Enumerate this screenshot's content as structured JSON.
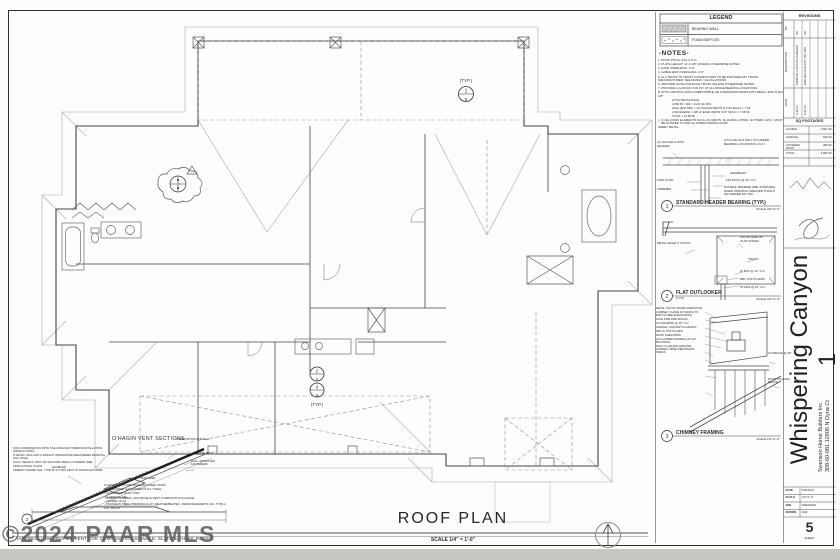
{
  "sheet": {
    "watermark": "©2024 PAAR MLS",
    "bottom_title": "ROOF PLAN",
    "bottom_scale": "SCALE 1/4\" = 1'-0\""
  },
  "plan": {
    "typ_top": "(TYP.)",
    "typ_bottom": "(TYP.)",
    "callout_top_num": "1",
    "callout_a_num": "2",
    "callout_b_num": "3",
    "callout_sheet": "5"
  },
  "legend": {
    "title": "LEGEND",
    "item1": "BEARING WALL",
    "item2": "FOAM BAFFLES"
  },
  "notes": {
    "title": "-NOTES-",
    "items": [
      "1.  ROOF PITCH: 5/12 U.N.O.",
      "2.  PLATE HEIGHT: 11'-0 1/8\" UNLESS OTHERWISE NOTED",
      "3.  EAVE OVERHANG: 2'-0\"",
      "4.  GABLE END OVERHANG: 2'-0\"",
      "5.  ALL TRUSS TO TRUSS CONNECTIONS TO BE PROVIDED BY TRUSS MANUFACTURER. SEE MANUF. CALCULATIONS",
      "6.  PROVIDE H2.5A FOR EACH TRUSS UNLESS OTHERWISE NOTED",
      "7.  PROVIDE A 2x ROOF FOR PLY AT ALL RIDGE BEARING LOCATIONS.",
      "8.  ATTIC VENTING NON-COMBUSTIBLE OR CORROSION RESISTANT MESH LESS THAN 1/8\":"
    ],
    "vent": [
      "ATTIC VENTILATION:",
      "4,266 SF / 300 = 14.21 SF MIN.",
      "HIGH (50% MIN) = 14 O'HAGIN VENTS (0.5 SF EACH) = 7 SF",
      "LOW (EAVES) = 106 LF EAVE VENTS (0.07 SF/LF) = 7.38 SF",
      "TOTAL = 14.38 SF"
    ],
    "flag": "△",
    "note9": "9.  ALL ROOF ELEMENTS SUCH AS VENTS, FLASHING, PIPES, GUTTERS, ETC., MUST BE PAINTED TO MATCH SURROUNDING ROOF.",
    "sheet_metal": "SHEET METAL:"
  },
  "details": [
    {
      "num": "1",
      "title": "STANDARD HEADER BEARING (TYP.)",
      "scale": "SCALE 3/4\"=1'-0\"",
      "labels": [
        "(2) 16d NAILS INTO HEADER",
        "KING STUD",
        "TRIMMER",
        "GT12 OR H2.5 ONLY IN GIRDER BEARING LOCATIONS U.N.O.",
        "HDR/BEAM",
        "16d NAILS @ 12\" O.C.",
        "DOUBLE TRIMMER (DBL SUPPLIED) WHEN OPENING GREATER THAN 6' OR GIRDER ON TOP"
      ]
    },
    {
      "num": "2",
      "title": "FLAT OUTLOOKER",
      "subtitle": "(TYP.)",
      "scale": "SCALE 3/4\"=1'-0\"",
      "labels": [
        "METAL EDGE 2\" RS FIN",
        "2x6 ON SIDE OF OUTLOOKER",
        "TRUSS",
        "2x BLK @ 12\" O.C.",
        "DBL TOP PLATES",
        "STUDS @ 16\" O.C."
      ]
    },
    {
      "num": "3",
      "title": "CHIMNEY FRAMING",
      "scale": "SCALE 1/2\"=1'-0\"",
      "labels": [
        "METAL CAP W/ SPARK ARRESTOR",
        "CHIMNEY CHASE W/ SIDING TO MATCH (SEE ELEVATIONS)",
        "FLUE PIPE PER MANUF.",
        "2x4 FRAMING @ 16\" O.C.",
        "SADDLE / CRICKET FLASHING",
        "DBL 2x TOP PLATES",
        "ROOF SHEATHING",
        "2x6 LADDER FRAMING W/ 2x6 BLOCKING",
        "GALV. FLASHING AROUND CHIMNEY BASE PER MANUF. SPECS",
        "2x4 BRACE @ 45°",
        "ROOF TRUSSES BELOW"
      ]
    }
  ],
  "ohagin": {
    "title": "O'HAGIN VENT SECTIONS",
    "callout": "2",
    "notes": [
      "FOR COORDINATION WITH TILE MANUFACTURERS INSTALLATION INSTRUCTIONS,",
      "O'HAGIN, SULLIVAN & WRIGHT INTEGRATED WEATHERED BONDING NAIL HOLE,",
      "GALV. (SELECT) ZINC OR SILICONE AREAS COVERED (SEE APPLICATION) FLASH",
      "CEMENT GRADE TILE. TYPE 'B' STYLES VENT AT MANUFACTURER."
    ],
    "specs": [
      "O'HAGIN VENTS ARE MANUFACTURED USING:",
      "-  PRE-PAINTED GALVANIZED 26 GA. STEEL",
      "-  GALVANIZED 26 GA. ZINC",
      "-  ALUMINUM .032",
      "-  COPPER 16 OZ.",
      "-  STAINLESS STEEL PREMIUM ALLOY WEATHERBEATEN - REINFORCEMENTS 110 - TYPE A 110 - BOLTS"
    ],
    "labels": {
      "chamfer": "CHAMFER",
      "shingle": "COMPOSITION SHINGLE",
      "deck": "ROOF DECK",
      "fasteners": "GALV. APPROVED FASTENERS",
      "vent_area": "VENT AREA",
      "flat": "O'HAGIN TAPERED, LOW-PROFILE VENT (COMPOSITION FLANGE)"
    },
    "caption": "TAPERED, LOW-PROFILE VENT FOR COMPOSITION SHINGLE, SLATE & SHAKE ROOFS"
  },
  "titleblock": {
    "revisions": {
      "title": "REVISIONS",
      "col_by": "BY",
      "col_desc": "DESCRIPTION",
      "col_date": "DATE",
      "entries": [
        {
          "by": "JW",
          "desc": "WINDOW / LAYOUT CHANGES",
          "date": "4-18-24"
        },
        {
          "by": "JW",
          "desc": "ENG REV PER CITY OR HOA",
          "date": "8-26-24"
        }
      ]
    },
    "sq": {
      "title": "SQ FOOTAGES",
      "rows": [
        {
          "label": "LIVABLE",
          "value": "2,561 SF"
        },
        {
          "label": "GARAGE",
          "value": "946 SF"
        },
        {
          "label": "COVERED PATIO",
          "value": "389 SF"
        },
        {
          "label": "TOTAL",
          "value": "3,896 SF"
        }
      ]
    },
    "project_title": "Whispering Canyon 1",
    "client_line1": "Swenson Home Builders Inc.",
    "client_line2": "308-60-081 12905 N Dyna Ct",
    "info": {
      "date_label": "DATE",
      "date_value": "9/26/2024",
      "scale_label": "SCALE",
      "scale_value": "1/4\"=1'-0\"",
      "job_label": "JOB",
      "job_value": "SWENSON",
      "drawn_label": "DRAWN",
      "drawn_value": "JAW"
    },
    "sheet_number": "5",
    "sheet_label": "SHEET"
  }
}
